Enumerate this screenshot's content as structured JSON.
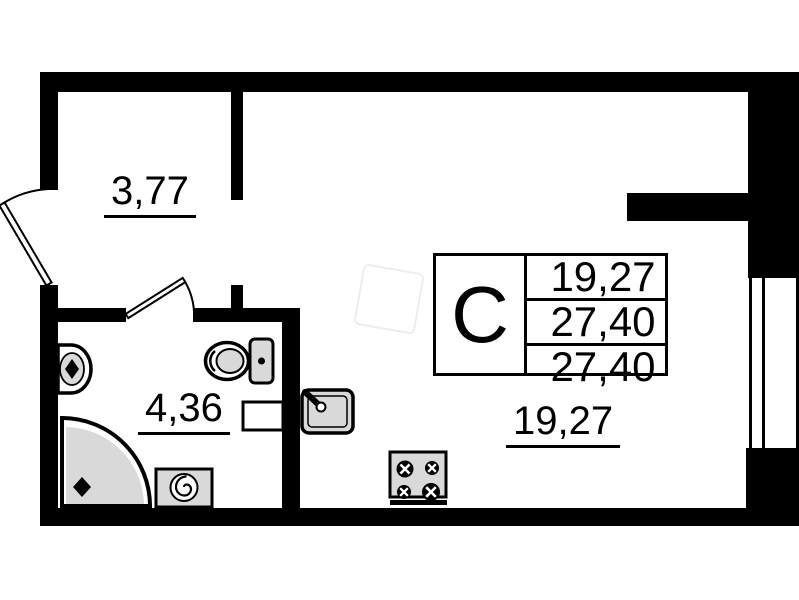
{
  "unit": {
    "type_label": "С",
    "table_rows": [
      "19,27",
      "27,40",
      "27,40"
    ]
  },
  "rooms": {
    "hallway": {
      "area": "3,77"
    },
    "bathroom": {
      "area": "4,36"
    },
    "living_kitchen": {
      "area": "19,27"
    }
  },
  "fixtures": [
    "entrance-door",
    "bathroom-door",
    "window",
    "wash-basin",
    "toilet",
    "corner-shower",
    "washing-machine",
    "ventilation-niche",
    "kitchen-sink",
    "stove"
  ],
  "colors": {
    "walls": "#000000",
    "fixture_fill": "#d9d9d9",
    "background": "#ffffff",
    "line": "#000000"
  }
}
